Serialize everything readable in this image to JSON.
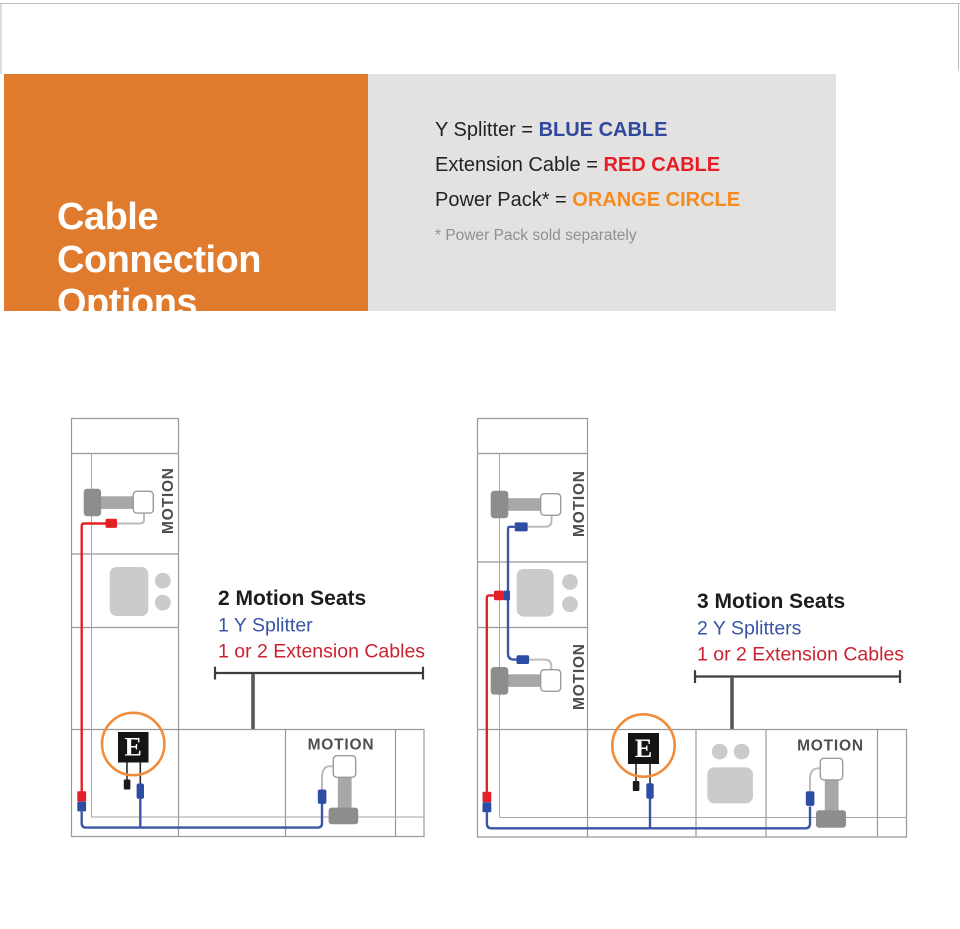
{
  "header": {
    "title_lines": [
      "Cable",
      "Connection",
      "Options"
    ]
  },
  "legend": {
    "items": [
      {
        "prefix": "Y Splitter = ",
        "value": "BLUE CABLE",
        "color": "#30489d"
      },
      {
        "prefix": "Extension Cable = ",
        "value": "RED CABLE",
        "color": "#e71e28"
      },
      {
        "prefix": "Power Pack* = ",
        "value": "ORANGE CIRCLE",
        "color": "#f68b1f"
      }
    ],
    "footnote": "* Power Pack sold separately"
  },
  "diagrams": [
    {
      "heading": "2 Motion Seats",
      "splitters": "1 Y Splitter",
      "extensions": "1 or 2 Extension Cables",
      "motion_labels": [
        "MOTION",
        "MOTION"
      ],
      "power_badge": "E"
    },
    {
      "heading": "3 Motion Seats",
      "splitters": "2 Y Splitters",
      "extensions": "1 or 2 Extension Cables",
      "motion_labels": [
        "MOTION",
        "MOTION",
        "MOTION"
      ],
      "power_badge": "E"
    }
  ],
  "colors": {
    "header_orange": "#e07a2d",
    "panel_gray": "#e3e2e1",
    "cable_blue": "#3c56a5",
    "cable_red": "#e32127",
    "power_circle_orange": "#f08d3d"
  }
}
